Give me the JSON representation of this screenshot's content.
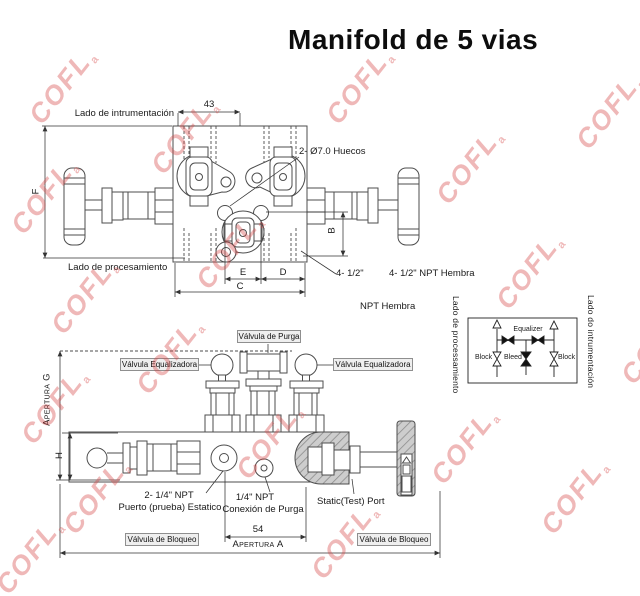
{
  "title": "Manifold de 5 vias",
  "watermark": {
    "text": "COFL",
    "mark": "a",
    "color": "#d64545"
  },
  "top_view": {
    "instrument_side_label": "Lado de intrumentación",
    "process_side_label": "Lado de procesamiento",
    "holes_label": "2- Ø7.0 Huecos",
    "ports_label_short": "4- 1/2\"",
    "ports_label_full": "4- 1/2\" NPT Hembra",
    "ports_label_thread": "NPT Hembra",
    "dims": {
      "top_width": "43",
      "f": "F",
      "b": "B",
      "e": "E",
      "d": "D",
      "c": "C"
    }
  },
  "bottom_view": {
    "purge_valve_label": "Válvula de Purga",
    "equalizer_valve_left_label": "Válvula Equalizadora",
    "equalizer_valve_right_label": "Válvula Equalizadora",
    "block_valve_left_label": "Válvula de Bloqueo",
    "block_valve_right_label": "Válvula de Bloqueo",
    "static_port_line1": "2- 1/4\" NPT",
    "static_port_line2": "Puerto (prueba) Estatico",
    "purge_conn_line1": "1/4\" NPT",
    "purge_conn_line2": "Conexión de Purga",
    "static_test_port_label": "Static(Test) Port",
    "dims": {
      "opening_g": "Apertura G",
      "h": "H",
      "port_spacing": "54",
      "opening_a": "Apertura A"
    }
  },
  "schematic": {
    "process_side_label": "Lado de processamiento",
    "instrument_side_label": "Lado do intrumentación",
    "equalizer_label": "Equalizer",
    "block_left_label": "Block",
    "bleed_label": "Bleed",
    "block_right_label": "Block"
  }
}
